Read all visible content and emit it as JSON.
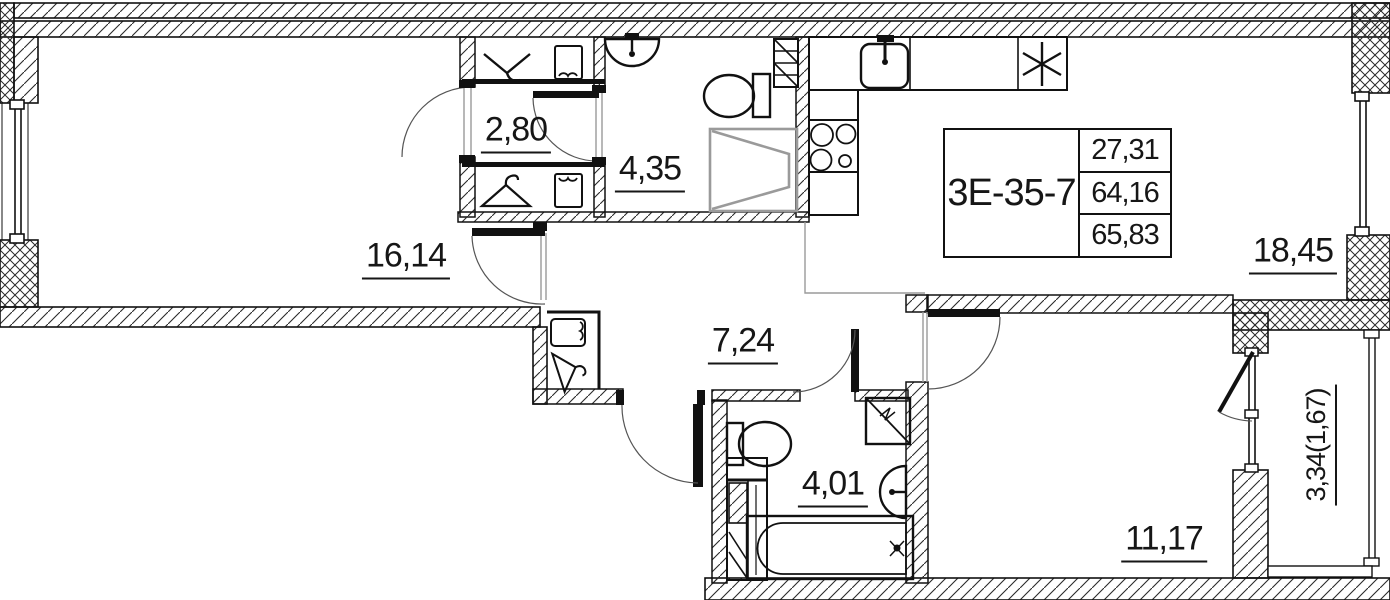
{
  "title_block": {
    "unit_code": "3Е-35-7",
    "rows": [
      {
        "value": "27,31"
      },
      {
        "value": "64,16"
      },
      {
        "value": "65,83"
      }
    ]
  },
  "room_labels": {
    "bedroom": "16,14",
    "wardrobe": "2,80",
    "bathroom_master": "4,35",
    "kitchen_living": "18,45",
    "hallway": "7,24",
    "bathroom": "4,01",
    "bedroom2": "11,17",
    "balcony": "3,34(1,67)"
  },
  "fixtures": [
    "clothes-rail-icon",
    "shelf-icon",
    "hanger-icon",
    "washbasin-icon",
    "toilet-icon",
    "shower-tray-icon",
    "kitchen-sink-icon",
    "cooktop-4-burner-icon",
    "refrigerator-asterisk-icon",
    "washing-machine-icon",
    "bathtub-icon",
    "vent-shaft-icon",
    "door-swing-arc",
    "window",
    "balcony-door"
  ],
  "colors": {
    "line": "#161616",
    "hatch": "#2a2a2a",
    "shower_gray": "#9a9a9a",
    "zone_gray": "#9a9a9a",
    "background": "#ffffff"
  }
}
